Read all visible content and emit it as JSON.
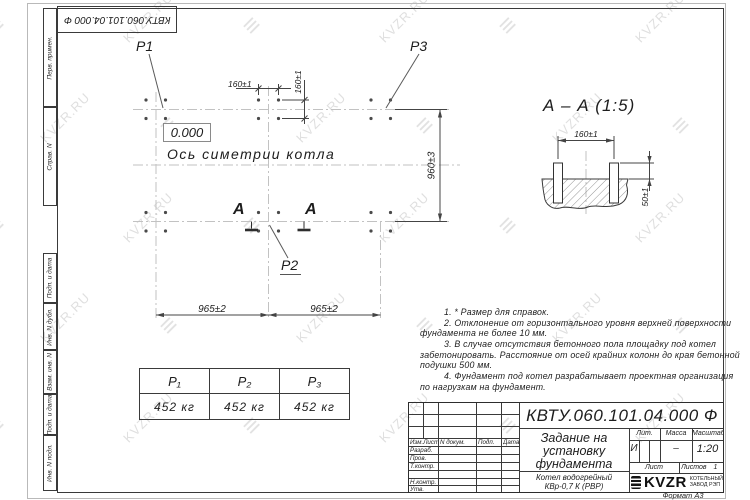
{
  "watermark": {
    "text": "KVZR.RU",
    "logo_glyph": "≡"
  },
  "corner_stamp": {
    "doc_number": "КВТУ.060.101.04.000 Ф"
  },
  "side_strip": {
    "perv_primen": "Перв. примен.",
    "sprav_n": "Справ. N",
    "podp_data_1": "Подп. и дата",
    "inv_dubl": "Инв. N дубл.",
    "vzam_inv": "Взам. инв. N",
    "podp_data_2": "Подп. и дата",
    "inv_podl": "Инв. N подл."
  },
  "plan": {
    "label_p1": "P1",
    "label_p2": "P2",
    "label_p3": "P3",
    "elevation": "0.000",
    "axis_label": "Ось симетрии котла",
    "section_letter_left": "А",
    "section_letter_right": "А",
    "dim_160_top": "160±1",
    "dim_160_side": "160±1",
    "dim_965_left": "965±2",
    "dim_965_right": "965±2",
    "dim_960": "960±3"
  },
  "section_view": {
    "title": "А – А (1:5)",
    "dim_160": "160±1",
    "dim_50": "50±1"
  },
  "notes": {
    "lines": [
      "1. * Размер для справок.",
      "2. Отклонение от горизонтального уровня верхней поверхности",
      "фундамента не более 10 мм.",
      "3. В случае отсутствия бетонного пола площадку под котел",
      "забетонировать. Расстояние от осей крайних колонн до края бетонной",
      "подушки 500 мм.",
      "4. Фундамент под котел разрабатывает проектная организация",
      "по нагрузкам на фундамент."
    ]
  },
  "load_table": {
    "headers": [
      "P₁",
      "P₂",
      "P₃"
    ],
    "values": [
      "452 кг",
      "452 кг",
      "452 кг"
    ]
  },
  "title_block": {
    "doc_number": "КВТУ.060.101.04.000 Ф",
    "title_line1": "Задание на",
    "title_line2": "установку",
    "title_line3": "фундамента",
    "product_line1": "Котел водогрейный",
    "product_line2": "КВр-0,7 К (РВР)",
    "col_izm": "Изм.Лист",
    "col_dokum": "N докум.",
    "col_podp": "Подп.",
    "col_data": "Дата",
    "row_razrab": "Разраб.",
    "row_prov": "Пров.",
    "row_tkontr": "Т.контр.",
    "row_nkontr": "Н.контр.",
    "row_utv": "Утв.",
    "lit_label": "Лит.",
    "lit_value": "И",
    "mass_label": "Масса",
    "mass_value": "–",
    "scale_label": "Масштаб",
    "scale_value": "1:20",
    "list_label": "Лист",
    "listov_label": "Листов",
    "listov_value": "1",
    "logo_text": "KVZR",
    "logo_line1": "КОТЕЛЬНЫЙ",
    "logo_line2": "ЗАВОД РЭП",
    "format_label": "Формат А3"
  }
}
